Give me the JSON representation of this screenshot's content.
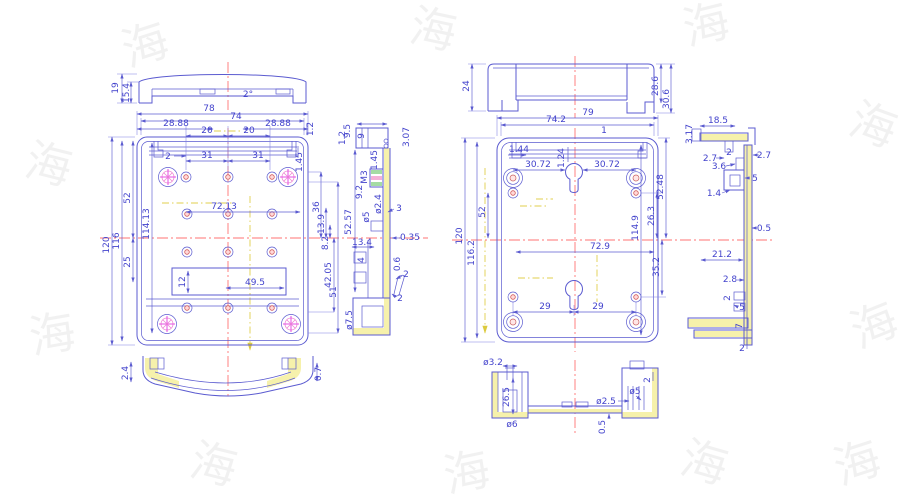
{
  "drawing_type": "mechanical-dimension-drawing",
  "colors": {
    "line": "#5b5bd0",
    "dim_text": "#4343cc",
    "centerline": "#ff7373",
    "aux_line": "#e0cf4e",
    "section_highlight": "#f6f1ab",
    "boss_hatch": "#ef86d5"
  },
  "watermark": {
    "glyph": "海"
  },
  "left_lid": {
    "h": "19",
    "hi": "15.4",
    "angle": "2°"
  },
  "left_top": {
    "w_out": "78",
    "w_in": "74",
    "e_l": "28.88",
    "p_l": "20",
    "p_r": "20",
    "e_r": "28.88",
    "lip": "1.2",
    "c2": "2",
    "s_l": "31",
    "s_r": "31",
    "lip2": "1.45"
  },
  "left_side": {
    "h_out": "120",
    "h_in": "116",
    "d52": "52",
    "d25": "25",
    "d114": "114.13"
  },
  "left_inner": {
    "span": "72.13",
    "slot_h": "12",
    "slot_w": "49.5"
  },
  "left_chain": {
    "d36": "36",
    "d13_9": "13.9",
    "d8_2": "8.2",
    "d42": "42.05",
    "d51": "51"
  },
  "left_sec": {
    "d9_5": "9.5",
    "d9": "9",
    "d3_07": "3.07",
    "d1_2": "1.2",
    "d1_45": "1.45",
    "m3": "M3",
    "d9_2": "9.2",
    "dia2_4": "ø2.4",
    "dia5": "ø5",
    "d3": "3",
    "d52_57": "52.57",
    "d13_4": "13.4",
    "d4": "4",
    "d0_35": "0.35",
    "d0_6": "0.6",
    "d2a": "2",
    "d2b": "2",
    "dia7_5": "ø7.5"
  },
  "left_bottom": {
    "d2_4": "2.4",
    "d0_7": "0.7"
  },
  "right_lid": {
    "d24": "24",
    "d28_6": "28.6",
    "d30_6": "30.6"
  },
  "right_top": {
    "w_out": "79",
    "w_in": "74.2",
    "d1_44": "1.44",
    "d1_24": "1.24",
    "d1": "1",
    "k_l": "30.72",
    "k_r": "30.72"
  },
  "right_side": {
    "h_out": "120",
    "h_in": "116.2",
    "d52": "52",
    "d52_48": "52.48",
    "d26_3": "26.3",
    "d114_9": "114.9",
    "d35_2": "35.2"
  },
  "right_inner": {
    "span": "72.9",
    "d29a": "29",
    "d29b": "29"
  },
  "right_sec": {
    "d3_17": "3.17",
    "d18_5": "18.5",
    "d2a": "2",
    "d2_7a": "2.7",
    "d2_7b": "2.7",
    "d3_6": "3.6",
    "d5a": "5",
    "d1_4": "1.4",
    "d0_5": "0.5",
    "d21_2": "21.2",
    "d2_8": "2.8",
    "d2b": "2",
    "d5b": "5",
    "d7": "7",
    "d2c": "2"
  },
  "bottom_detail": {
    "dia3_2": "ø3.2",
    "d26_5": "26.5",
    "dia6": "ø6",
    "dia2_5": "ø2.5",
    "dia5": "ø5",
    "d0_5": "0.5",
    "d2": "2"
  }
}
